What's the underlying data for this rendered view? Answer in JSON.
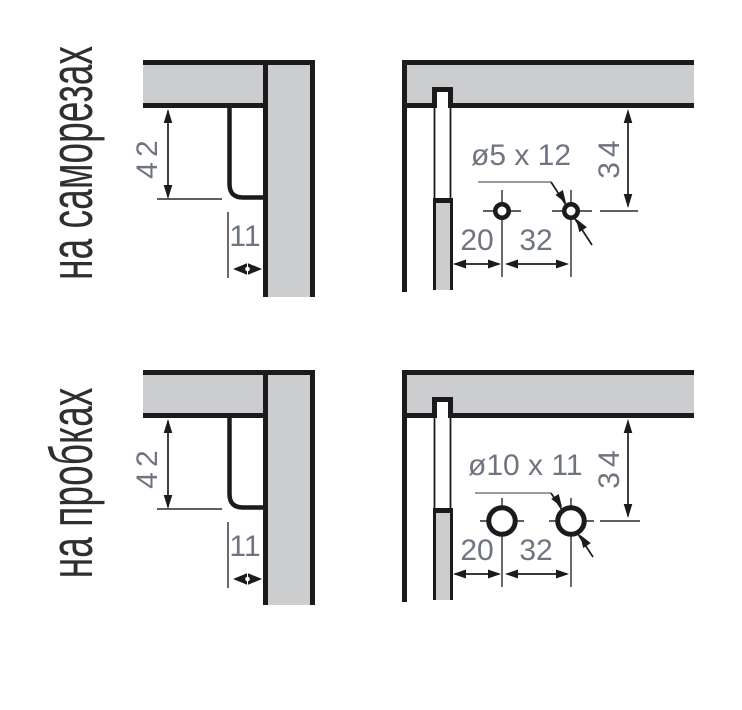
{
  "colors": {
    "background": "#ffffff",
    "panel_fill": "#cccdce",
    "line_dark": "#1b1b1d",
    "thin_line": "#2a2a2c",
    "dim_text": "#6e7480",
    "label_text": "#2f2f31",
    "leader": "#9b9b9b"
  },
  "sections": [
    {
      "id": "screws",
      "side_label": "на саморезах",
      "corner": {
        "height": "42",
        "offset": "11"
      },
      "drilling": {
        "hole_spec": "ø5 x 12",
        "top_offset": "34",
        "edge_offset": "20",
        "spacing": "32"
      }
    },
    {
      "id": "plugs",
      "side_label": "на пробках",
      "corner": {
        "height": "42",
        "offset": "11"
      },
      "drilling": {
        "hole_spec": "ø10 x 11",
        "top_offset": "34",
        "edge_offset": "20",
        "spacing": "32"
      }
    }
  ]
}
